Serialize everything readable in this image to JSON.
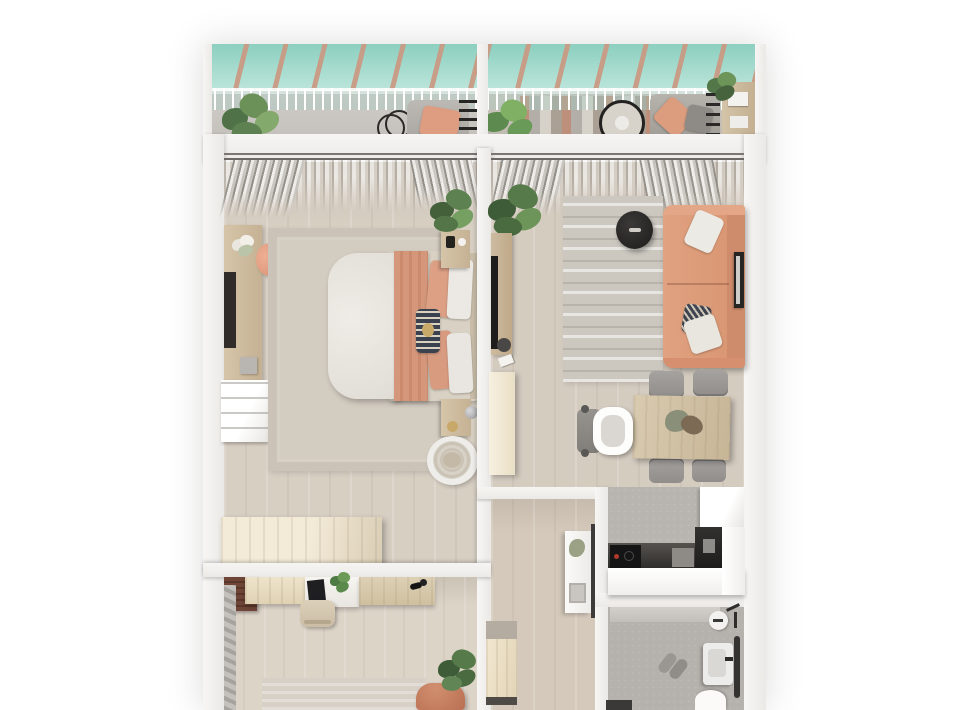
{
  "image_type": "3d-floor-plan-render",
  "palette": {
    "background": "#ffffff",
    "wall": "#f3f2f0",
    "wood_floor": "#d8cfc3",
    "rug_beige": "#d3ccc1",
    "rug_living": "#cbc6bd",
    "sofa_salmon": "#dc997b",
    "peach_accent": "#dda085",
    "glass_teal": "#9ed8ca",
    "beam_tan": "#c99a84",
    "counter_dark": "#3a3835",
    "counter_white": "#fcfcfb",
    "tile_gray": "#b8b5b0",
    "plant_green": "#5f8552",
    "terracotta_chair": "#c47a5e"
  },
  "rooms": [
    {
      "name": "balcony-left",
      "items": [
        "glass-roof",
        "railing",
        "potted-plant",
        "decor-rings",
        "lounge-chair",
        "peach-cushion"
      ]
    },
    {
      "name": "balcony-right",
      "items": [
        "glass-roof",
        "railing",
        "striped-rug",
        "potted-plant",
        "hanging-chair",
        "daybed",
        "ladder-shelf",
        "small-plant"
      ]
    },
    {
      "name": "bedroom",
      "items": [
        "curtains",
        "vanity",
        "mirror",
        "flowers",
        "peach-stool",
        "white-dresser",
        "area-rug",
        "double-bed",
        "peach-blanket",
        "pillows",
        "accent-pillow",
        "nightstand-top",
        "plant",
        "nightstand-bottom",
        "lamp",
        "basket-chair",
        "sideboard"
      ]
    },
    {
      "name": "living-room",
      "items": [
        "curtains",
        "plant",
        "tv-console",
        "tv",
        "speaker",
        "remote",
        "tall-cabinet",
        "patterned-rug",
        "coffee-table",
        "salmon-sofa",
        "sofa-pillows",
        "wall-frame"
      ]
    },
    {
      "name": "dining-area",
      "items": [
        "dining-table",
        "centerpiece",
        "chair",
        "chair",
        "chair",
        "chair",
        "high-chair"
      ]
    },
    {
      "name": "kitchen",
      "items": [
        "fridge",
        "oven-tower",
        "dark-counter",
        "cooktop",
        "cutting-board",
        "white-counter"
      ]
    },
    {
      "name": "bathroom",
      "items": [
        "ceiling-light",
        "shower-set",
        "sink",
        "faucet",
        "towel-rail",
        "toilet",
        "slippers",
        "floor-item"
      ]
    },
    {
      "name": "hallway",
      "items": [
        "console-table",
        "decor-plant",
        "artwork",
        "door-frame",
        "shoe-bench"
      ]
    },
    {
      "name": "second-room",
      "items": [
        "dark-shelf",
        "glass-panel",
        "wall-cabinets",
        "desk",
        "laptop",
        "desk-plant",
        "wood-desk",
        "desk-lamp",
        "desk-chair",
        "rug",
        "terracotta-armchair",
        "plant"
      ]
    }
  ]
}
